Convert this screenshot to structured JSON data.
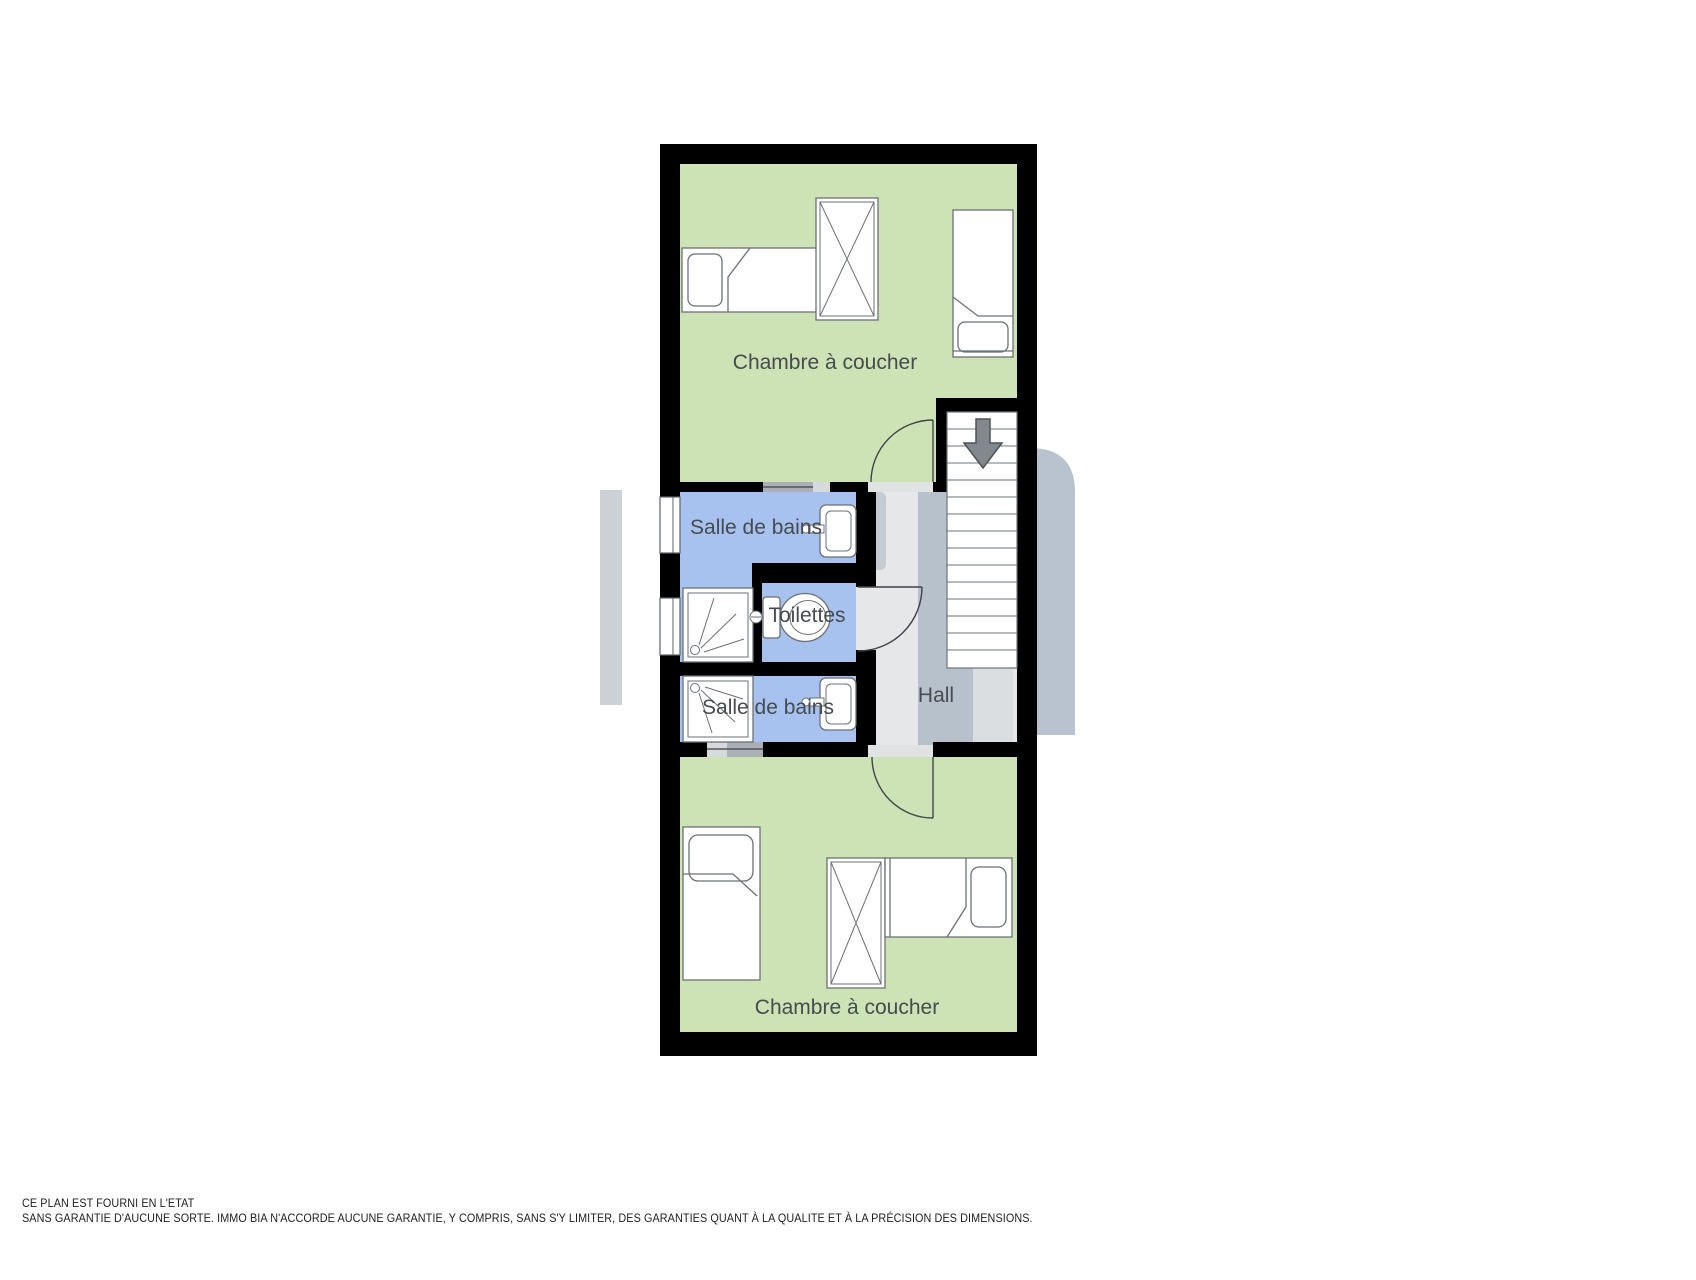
{
  "floorplan": {
    "rooms": {
      "bedroom_top": {
        "label": "Chambre à coucher"
      },
      "bathroom_top": {
        "label": "Salle de bains"
      },
      "toilet": {
        "label": "Toilettes"
      },
      "bathroom_bottom": {
        "label": "Salle de bains"
      },
      "hall": {
        "label": "Hall"
      },
      "bedroom_bottom": {
        "label": "Chambre à coucher"
      }
    },
    "stairs": {
      "icon": "arrow-down-icon",
      "steps": 15
    },
    "fixtures": [
      "bed",
      "bed",
      "wardrobe",
      "sink",
      "shower",
      "toilet",
      "sink",
      "shower",
      "bed",
      "bed",
      "wardrobe"
    ],
    "colors": {
      "room_green": "#cde3b5",
      "room_blue": "#a8c2ef",
      "wall": "#000000",
      "hall_light": "#e5e7e8",
      "hall_shade": "#b7c1cc",
      "hall_shade_soft": "#dbdee0",
      "outside_shadow": "#b9c3d0",
      "outside_shadow_left": "#ccd1d6",
      "furniture_stroke": "#6b7075",
      "door_stroke": "#3f4449",
      "label_color": "#454b50"
    }
  },
  "disclaimer": {
    "line1": "CE PLAN EST FOURNI EN L'ETAT",
    "line2": "SANS GARANTIE D'AUCUNE SORTE. IMMO BIA N'ACCORDE AUCUNE GARANTIE, Y COMPRIS, SANS S'Y LIMITER, DES GARANTIES QUANT À LA QUALITE ET À LA PRÉCISION DES DIMENSIONS."
  }
}
